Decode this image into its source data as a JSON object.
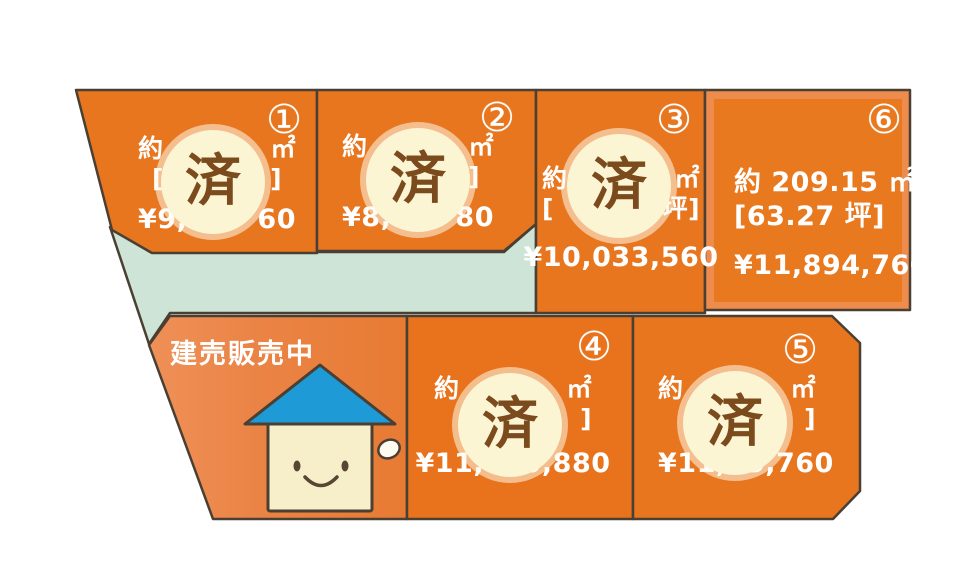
{
  "banner": {
    "label": "建売販売中"
  },
  "sold_badge": "済",
  "plots": [
    {
      "number": "①",
      "status": "済",
      "sold": true,
      "area_prefix": "約",
      "area_suffix": "㎡",
      "tsubo_prefix": "[",
      "tsubo_suffix": "]",
      "price_prefix": "¥9,2",
      "price_suffix": "60"
    },
    {
      "number": "②",
      "status": "済",
      "sold": true,
      "area_prefix": "約",
      "area_suffix": "㎡",
      "tsubo_prefix": "",
      "tsubo_suffix": "]",
      "price_prefix": "¥8,99",
      "price_suffix": "80"
    },
    {
      "number": "③",
      "status": "済",
      "sold": true,
      "area_prefix": "約",
      "area_suffix": "㎡",
      "tsubo_prefix": "[",
      "tsubo_suffix": "坪]",
      "price": "¥10,033,560"
    },
    {
      "number": "④",
      "status": "済",
      "sold": true,
      "area_prefix": "約",
      "area_suffix": "㎡",
      "tsubo_prefix": "",
      "tsubo_suffix": "]",
      "price": "¥11,510,880"
    },
    {
      "number": "⑤",
      "status": "済",
      "sold": true,
      "area_prefix": "約",
      "area_suffix": "㎡",
      "tsubo_prefix": "",
      "tsubo_suffix": "]",
      "price_prefix": "¥11,5",
      "price_suffix": "5,760"
    },
    {
      "number": "⑥",
      "status": "available",
      "sold": false,
      "area": "約 209.15 ㎡",
      "tsubo": "[63.27 坪]",
      "price": "¥11,894,760"
    }
  ],
  "colors": {
    "plot_orange": "#E8761F",
    "house_plot_orange": "#EA8344",
    "house_plot_orange_light": "#EF9058",
    "plot6_frame": "#EE8C4E",
    "road_green": "#CEE4D7",
    "outline_dark": "#4A3F33",
    "sold_circle_bg": "#FBF5D3",
    "sold_circle_text": "#7B4A1D",
    "roof_blue": "#1E9AD6",
    "house_body_cream": "#F7EFC9",
    "text_white": "#FFFFFF"
  }
}
